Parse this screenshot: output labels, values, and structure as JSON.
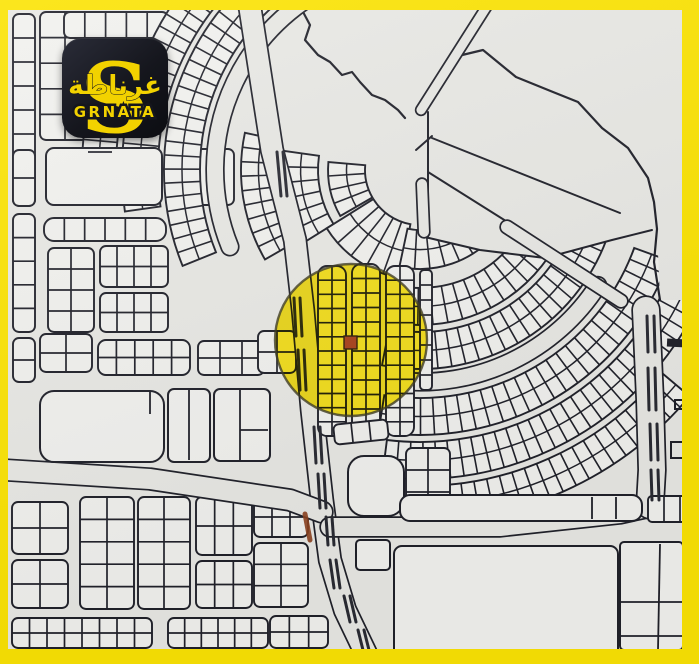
{
  "logo": {
    "arabic": "غرناطة",
    "latin": "GRNATA",
    "mark": "S"
  },
  "colors": {
    "frame": "#FBE304",
    "map_bg": "#E8E8E4",
    "plot_fill": "#F1F1EE",
    "line": "#20212A",
    "dash": "#2A2B33",
    "highlight": "#FFE600",
    "highlight_ring": "#3C3A22",
    "marker": "#A8431D",
    "marker_edge": "#30200A",
    "mark_red": "#8E4320",
    "logo_bg": "#15161D",
    "logo_yellow": "#F2D200"
  },
  "highlight": {
    "shape": "circle",
    "cx": 351,
    "cy": 340,
    "r": 76,
    "marker": {
      "x": 344,
      "y": 336,
      "w": 13,
      "h": 13
    }
  }
}
